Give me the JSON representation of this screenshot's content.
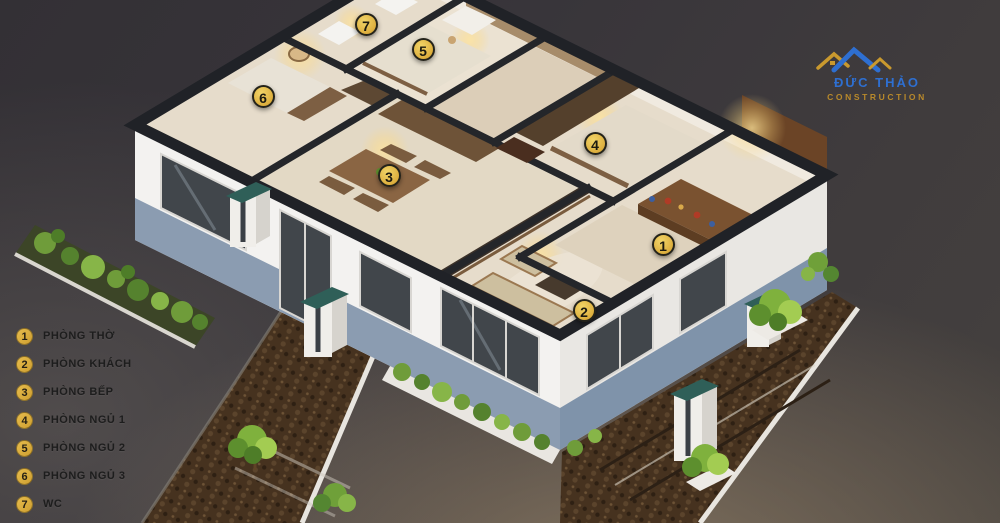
{
  "branding": {
    "name_line1": "ĐỨC THẢO",
    "name_line2": "CONSTRUCTION"
  },
  "legend": {
    "items": [
      {
        "num": "1",
        "label": "PHÒNG THỜ"
      },
      {
        "num": "2",
        "label": "PHÒNG KHÁCH"
      },
      {
        "num": "3",
        "label": "PHÒNG BẾP"
      },
      {
        "num": "4",
        "label": "PHÒNG NGỦ 1"
      },
      {
        "num": "5",
        "label": "PHÒNG NGỦ 2"
      },
      {
        "num": "6",
        "label": "PHÒNG NGỦ 3"
      },
      {
        "num": "7",
        "label": "WC"
      }
    ]
  },
  "markers": [
    {
      "num": "1",
      "x": 663,
      "y": 244
    },
    {
      "num": "2",
      "x": 584,
      "y": 310
    },
    {
      "num": "3",
      "x": 389,
      "y": 175
    },
    {
      "num": "4",
      "x": 595,
      "y": 143
    },
    {
      "num": "5",
      "x": 423,
      "y": 49
    },
    {
      "num": "6",
      "x": 263,
      "y": 96
    },
    {
      "num": "7",
      "x": 366,
      "y": 24
    }
  ],
  "palette": {
    "marker_fill": "#ddaf3e",
    "marker_border": "#24231a",
    "marker_text": "#1c1a10",
    "legend_text": "#1d1d1d",
    "logo_blue": "#2e6fd1",
    "logo_gold": "#b8892b",
    "background": "#3a3734"
  }
}
